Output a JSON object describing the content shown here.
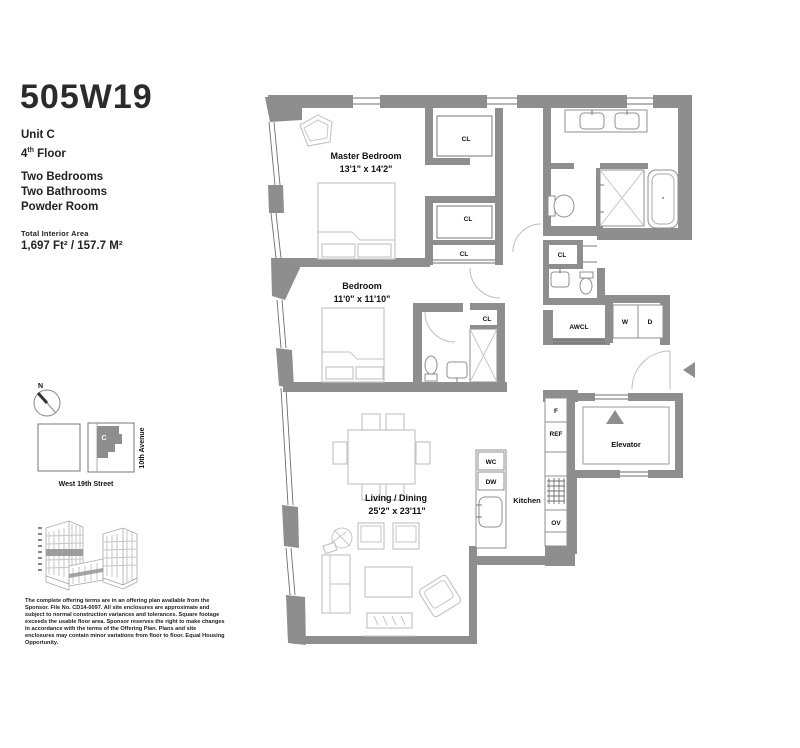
{
  "header": {
    "title": "505W19",
    "unit": "Unit C",
    "floor": {
      "num": "4",
      "sup": "th",
      "rest": " Floor"
    },
    "features": [
      "Two Bedrooms",
      "Two Bathrooms",
      "Powder Room"
    ],
    "area_label": "Total Interior Area",
    "area_value": "1,697 Ft² / 157.7 M²"
  },
  "site_map": {
    "compass": "N",
    "street": "West 19th Street",
    "avenue": "10th Avenue",
    "unit_marker": "C"
  },
  "plan": {
    "rooms": {
      "master_bedroom": {
        "name": "Master Bedroom",
        "dims": "13'1\" x 14'2\""
      },
      "bedroom": {
        "name": "Bedroom",
        "dims": "11'0\" x 11'10\""
      },
      "living_dining": {
        "name": "Living / Dining",
        "dims": "25'2\" x 23'11\""
      },
      "kitchen": "Kitchen",
      "elevator": "Elevator"
    },
    "labels": {
      "cl": "CL",
      "awcl": "AWCL",
      "washer": "W",
      "dryer": "D",
      "fridge": "REF",
      "freezer": "F",
      "oven": "OV",
      "dishwasher": "DW",
      "wine_cooler": "WC"
    }
  },
  "disclaimer": "The complete offering terms are in an offering plan available from the Sponsor. File No. CD14-0097. All site enclosures are approximate and subject to normal construction variances and tolerances. Square footage exceeds the usable floor area. Sponsor reserves the right to make changes in accordance with the terms of the Offering Plan. Plans and site enclosures may contain minor variations from floor to floor. Equal Housing Opportunity.",
  "colors": {
    "wall": "#8e8e8e",
    "furniture": "#c6c6c6",
    "fixture": "#8f8f8f",
    "text": "#111111"
  }
}
